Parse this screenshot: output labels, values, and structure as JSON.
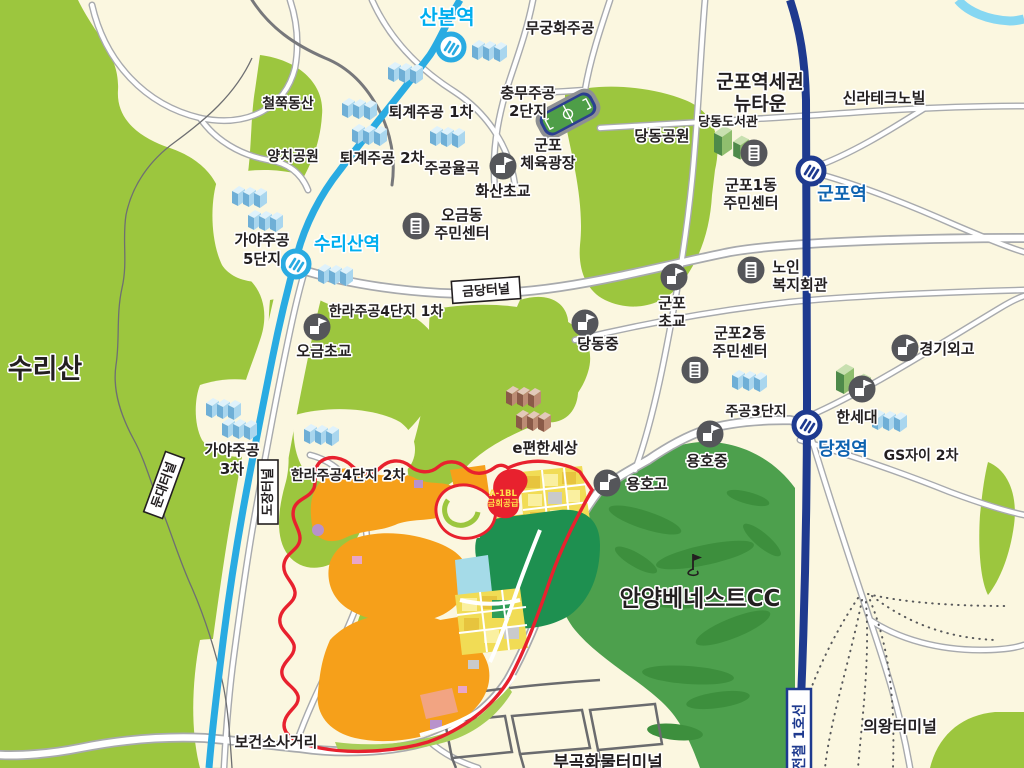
{
  "colors": {
    "background_cream": "#FBF7E0",
    "mountain_green": "#9CC63E",
    "golf_green": "#4DA04D",
    "golf_blob": "#3D8F3D",
    "line4_blue": "#29ABE2",
    "line1_navy": "#1E3A8F",
    "station_label_line4": "#00AEEF",
    "station_label_line1": "#0E63B0",
    "dev_boundary_red": "#E8212E",
    "dev_orange": "#F6A01A",
    "dev_yellow": "#F1DC55",
    "dev_park_green": "#1E9050",
    "dev_light_blue": "#A5DBE8",
    "apartment_blue": "#A9D6EE",
    "apartment_brown": "#BC8B74",
    "icon_gray": "#55565A",
    "text_black": "#231F20"
  },
  "stations": {
    "sanbon": "산본역",
    "surisan": "수리산역",
    "gunpo": "군포역",
    "dangjeong": "당정역",
    "line1_label": "전철 1호선"
  },
  "apartments": {
    "mugunghwa": "무궁화주공",
    "chungmu_line1": "충무주공",
    "chungmu_line2": "2단지",
    "toegye1": "퇴계주공 1차",
    "toegye2": "퇴계주공 2차",
    "yulgok": "주공율곡",
    "gaya5_line1": "가야주공",
    "gaya5_line2": "5단지",
    "gaya3_line1": "가야주공",
    "gaya3_line2": "3차",
    "halla1": "한라주공4단지 1차",
    "halla2": "한라주공4단지 2차",
    "jugong3": "주공3단지",
    "gs_xi": "GS자이 2차",
    "epyeonhan": "e편한세상"
  },
  "schools": {
    "hwasan": "화산초교",
    "ogeum_elem": "오금초교",
    "gunpo_elem_line1": "군포",
    "gunpo_elem_line2": "초교",
    "dangdong_middle": "당동중",
    "yongho_middle": "용호중",
    "yongho_high": "용호고",
    "gyeonggi_foreign": "경기외고",
    "hansei": "한세대"
  },
  "public_facilities": {
    "ogeum_center_line1": "오금동",
    "ogeum_center_line2": "주민센터",
    "gunpo1_center_line1": "군포1동",
    "gunpo1_center_line2": "주민센터",
    "gunpo2_center_line1": "군포2동",
    "gunpo2_center_line2": "주민센터",
    "senior_line1": "노인",
    "senior_line2": "복지회관",
    "dangdong_library": "당동도서관",
    "sports_line1": "군포",
    "sports_line2": "체육광장"
  },
  "parks": {
    "cheoljjuk": "철쭉동산",
    "yangchi": "양치공원",
    "dangdong_park": "당동공원",
    "surisan_mountain": "수리산"
  },
  "areas": {
    "newtown_line1": "군포역세권",
    "newtown_line2": "뉴타운",
    "silla": "신라테크노빌",
    "anyang_benest": "안양베네스트CC",
    "uiwang_terminal": "의왕터미널",
    "bugok_terminal": "부곡화물터미널",
    "bogeonso": "보건소사거리"
  },
  "tunnels": {
    "geumdang": "금당터널",
    "dojang": "도장터널",
    "dundae": "둔대터널"
  },
  "development": {
    "block_line1": "A-1BL",
    "block_line2": "금회공급"
  }
}
